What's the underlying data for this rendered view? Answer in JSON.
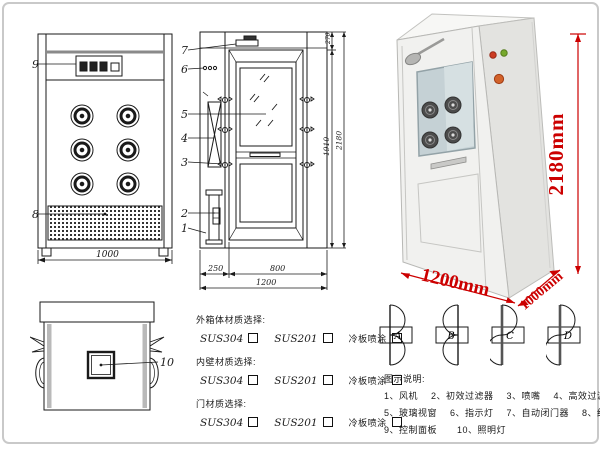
{
  "front_view": {
    "callout_control_panel": "9",
    "callout_grille": "8",
    "dim_width": "1000"
  },
  "side_view": {
    "callouts": [
      "7",
      "6",
      "5",
      "4",
      "3",
      "2",
      "1"
    ],
    "dim_left_column": "250",
    "dim_door": "800",
    "dim_total_width": "1200",
    "dim_top_section": "270",
    "dim_door_height": "1910",
    "dim_total_height": "2180"
  },
  "top_view": {
    "callout_lamp": "10"
  },
  "photo": {
    "dim_height": "2180mm",
    "dim_width": "1200mm",
    "dim_depth": "1000mm",
    "indicator_lights": [
      "red",
      "green",
      "orange"
    ]
  },
  "door_configs": {
    "a": "A",
    "b": "B",
    "c": "C",
    "d": "D"
  },
  "materials": {
    "groups": [
      {
        "title": "外箱体材质选择:",
        "opt1": "SUS304",
        "opt2": "SUS201",
        "opt3": "冷板喷涂"
      },
      {
        "title": "内壁材质选择:",
        "opt1": "SUS304",
        "opt2": "SUS201",
        "opt3": "冷板喷涂"
      },
      {
        "title": "门材质选择:",
        "opt1": "SUS304",
        "opt2": "SUS201",
        "opt3": "冷板喷涂"
      }
    ]
  },
  "legend": {
    "title": "图示说明:",
    "items": [
      "1、风机",
      "2、初效过滤器",
      "3、喷嘴",
      "4、高效过滤器",
      "5、玻璃视窗",
      "6、指示灯",
      "7、自动闭门器",
      "8、红外线感应器",
      "9、控制面板",
      "10、照明灯"
    ]
  },
  "colors": {
    "dimension_red": "#cc0000",
    "drawing_line": "#1a1a1a"
  }
}
